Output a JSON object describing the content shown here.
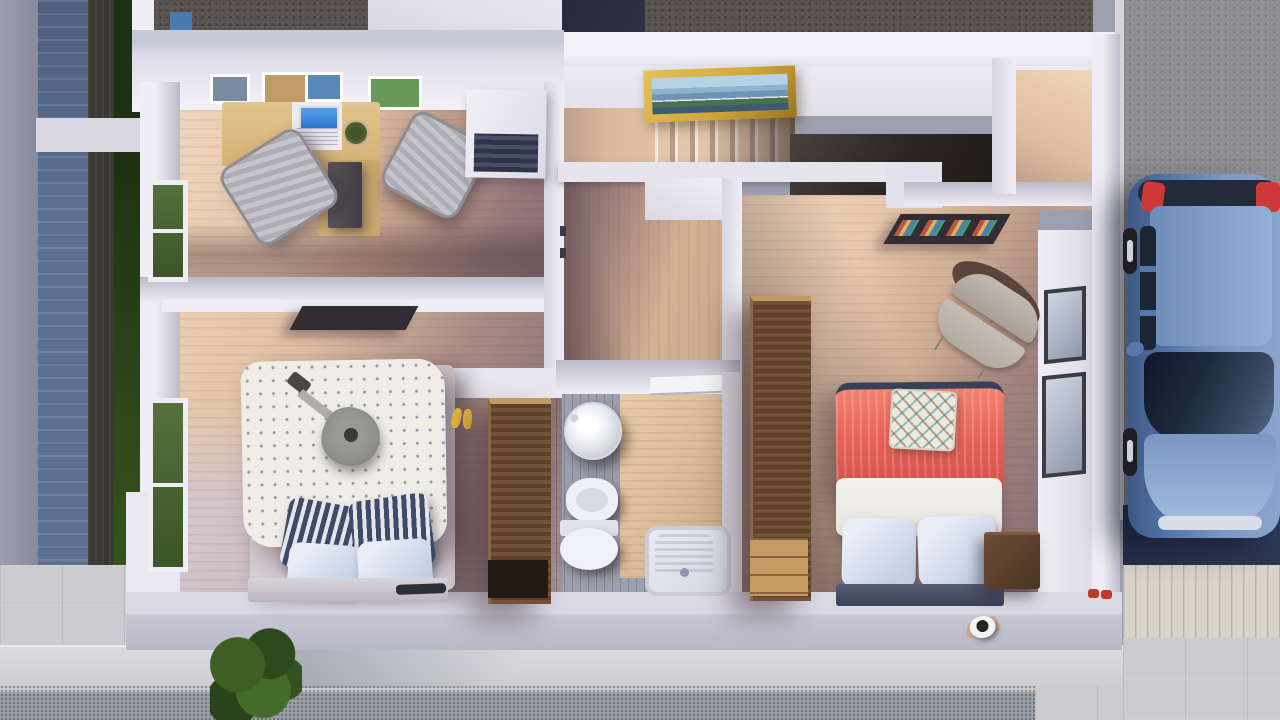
{
  "meta": {
    "title": "3D rendered top-down floor plan of an upper storey with office, two bedrooms, bathroom and stair hall; car parked on driveway at right",
    "canvas": {
      "width": 1280,
      "height": 720
    },
    "view": "top-down dollhouse cutaway render",
    "text_content": "none — image contains no readable text"
  },
  "rooms": [
    {
      "id": "office",
      "label": "Home office (top left)",
      "contents": [
        "L-shaped desk",
        "laptop",
        "two office chairs",
        "dark cabinet",
        "white dresser",
        "four wall pictures",
        "window"
      ]
    },
    {
      "id": "bedroom-1",
      "label": "Bedroom with guitar (bottom left)",
      "contents": [
        "double bed with dotted duvet",
        "acoustic guitar",
        "striped navy pillows",
        "blue pillows",
        "wall shelf",
        "wardrobe",
        "yellow slippers",
        "window",
        "phone on headboard"
      ]
    },
    {
      "id": "stair-hall",
      "label": "Stair hall (top middle)",
      "contents": [
        "gold framed landscape painting",
        "staircase descending right",
        "dark landing"
      ]
    },
    {
      "id": "corridor",
      "label": "Corridor (middle)",
      "contents": [
        "wood floor",
        "door to bathroom",
        "door jambs"
      ]
    },
    {
      "id": "bathroom",
      "label": "Bathroom (bottom middle)",
      "contents": [
        "round vessel sink",
        "bidet",
        "toilet",
        "shower tray",
        "walnut counter floor",
        "white door"
      ]
    },
    {
      "id": "bedroom-2",
      "label": "Master bedroom (right)",
      "contents": [
        "bed with coral red blanket",
        "diamond patterned cushion",
        "white sheet",
        "two blue pillows",
        "navy footboard",
        "nightstand",
        "tall wardrobe",
        "round lounge chair",
        "book wall shelf",
        "two windows",
        "red slippers"
      ]
    },
    {
      "id": "balcony",
      "label": "Roof terrace strips (top edge)",
      "contents": [
        "dark textured roof deck",
        "white parapet"
      ]
    }
  ],
  "exterior": [
    {
      "id": "driveway",
      "label": "Asphalt driveway with parked car (right)"
    },
    {
      "id": "car",
      "label": "Steel blue hatchback seen from above",
      "details": [
        "red taillights",
        "dark glass",
        "left-side wheels",
        "side mirror"
      ]
    },
    {
      "id": "yard",
      "label": "Lawn strip and concrete walkway (bottom)"
    },
    {
      "id": "tree",
      "label": "Small tree over walkway (bottom left)"
    },
    {
      "id": "person",
      "label": "Tiny person standing at bottom wall near right bedroom"
    },
    {
      "id": "fence",
      "label": "Blue-grey plank fence, dark wood strip and hedge (left edge)"
    },
    {
      "id": "deck",
      "label": "Light wood deck and concrete slabs (bottom right)"
    }
  ],
  "palette": {
    "wall": "#d8d7e2",
    "wallLit": "#efeef6",
    "wallShade": "#bbbac9",
    "wood": "#d9b89c",
    "woodShadow": "#8d7274",
    "walnut": "#4e3a30",
    "walnutDark": "#3a2a22",
    "wardrobe": "#5d4229",
    "wardrobeLight": "#74523a",
    "wardrobeDark": "#241a14",
    "wardrobeTan": "#c49a62",
    "duvet": "#efede6",
    "duvetDot": "#9c94a0",
    "navy": "#3e4b6b",
    "navyTrim": "#39415a",
    "pillowBlue": "#c2cee6",
    "sheet": "#f2f1ec",
    "red": "#e8645a",
    "redDeep": "#d4514a",
    "taupe": "#b3aaa2",
    "taupeDark": "#5b4439",
    "grass": "#58822f",
    "hedge": "#2c4719",
    "hedgeDark": "#1d3212",
    "concrete": "#cbcbd0",
    "concreteLight": "#dcdce0",
    "deck": "#d8d4ca",
    "asphalt": "#8d8d91",
    "navyMat": "#2c3854",
    "fence": "#5d7090",
    "neighbor": "#9b9fb0",
    "woodFence": "#3b3733",
    "roofDark": "#575250",
    "roofNavy": "#2e3444",
    "carBody": "#5878ac",
    "carBodyDark": "#3c5884",
    "carRoof": "#93b0d8",
    "carGlass": "#1c2534",
    "tail": "#cf3838",
    "wheel": "#1e1e22",
    "rim": "#cfd3da",
    "gold": "#d2a83c",
    "goldDark": "#9a7420",
    "paintSky": "#b7d2e4",
    "paintWater": "#6e93b4",
    "paintLand": "#49704f",
    "paintMount": "#3c5a70",
    "laptop": "#2f77cf",
    "kb": "#e6e6ec",
    "slipper": "#e3b83e",
    "skin": "#d9a886",
    "hair": "#2a2420",
    "guitar": "#8f8f8b",
    "guitarDark": "#4a4742",
    "shelf": "#332d33",
    "white": "#f4f3f7",
    "pic1": "#7a8aa0",
    "pic2": "#c09a6a",
    "pic3": "#5a88b8",
    "pic4": "#6a9a5a",
    "spineRed": "#b85548",
    "spineYellow": "#d8b556",
    "spineBlue": "#4f7fae",
    "spineGreen": "#3f9d72"
  }
}
